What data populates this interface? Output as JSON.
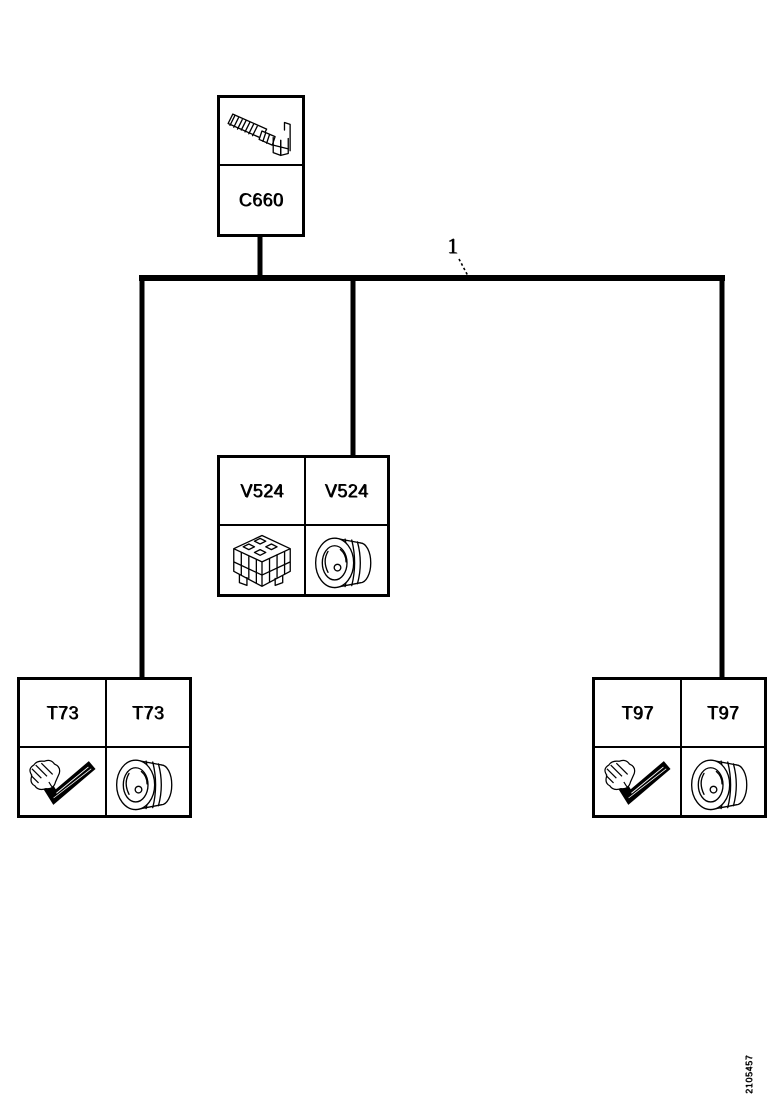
{
  "page": {
    "background_color": "#ffffff",
    "line_color": "#000000",
    "description": "Wiring harness connector location tree diagram"
  },
  "callout": {
    "label": "1"
  },
  "nodes": {
    "c660": {
      "label": "C660",
      "image": "terminal-pin-illustration"
    },
    "v524": {
      "labels": [
        "V524",
        "V524"
      ],
      "images": [
        "module-connector-illustration",
        "round-connector-illustration"
      ]
    },
    "t73": {
      "labels": [
        "T73",
        "T73"
      ],
      "images": [
        "harness-branch-illustration",
        "round-connector-illustration"
      ]
    },
    "t97": {
      "labels": [
        "T97",
        "T97"
      ],
      "images": [
        "harness-branch-illustration",
        "round-connector-illustration"
      ]
    }
  },
  "footer": {
    "doc_number": "2105457"
  }
}
